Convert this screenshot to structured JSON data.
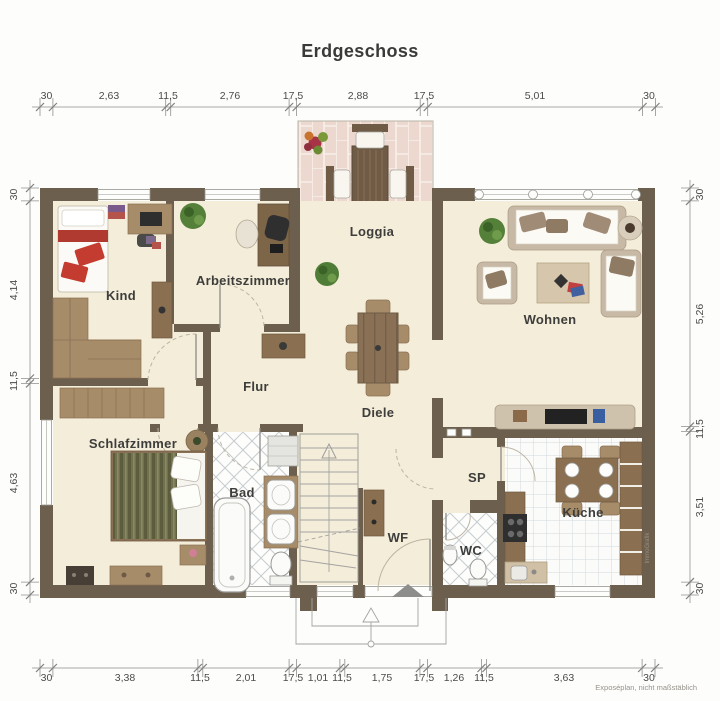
{
  "title": "Erdgeschoss",
  "caption": "Exposéplan, nicht maßstäblich",
  "watermark": "ImmoGrafik",
  "colors": {
    "wall": "#6d5f4e",
    "floor": "#f4edd9",
    "loggia_tile": "#ecd8cf",
    "accent_red": "#c0392b",
    "ruler": "#8f8f8d"
  },
  "rooms": {
    "kind": "Kind",
    "arbeitszimmer": "Arbeitszimmer",
    "loggia": "Loggia",
    "wohnen": "Wohnen",
    "flur": "Flur",
    "diele": "Diele",
    "schlafzimmer": "Schlafzimmer",
    "bad": "Bad",
    "wf": "WF",
    "sp": "SP",
    "wc": "WC",
    "kueche": "Küche"
  },
  "dimensions": {
    "top": [
      "30",
      "2,63",
      "11,5",
      "2,76",
      "17,5",
      "2,88",
      "17,5",
      "5,01",
      "30"
    ],
    "bottom": [
      "30",
      "3,38",
      "11,5",
      "2,01",
      "17,5",
      "1,01",
      "11,5",
      "1,75",
      "17,5",
      "1,26",
      "11,5",
      "3,63",
      "30"
    ],
    "left": [
      "30",
      "4,14",
      "11,5",
      "4,63",
      "30"
    ],
    "right": [
      "30",
      "5,26",
      "11,5",
      "3,51",
      "30"
    ]
  }
}
